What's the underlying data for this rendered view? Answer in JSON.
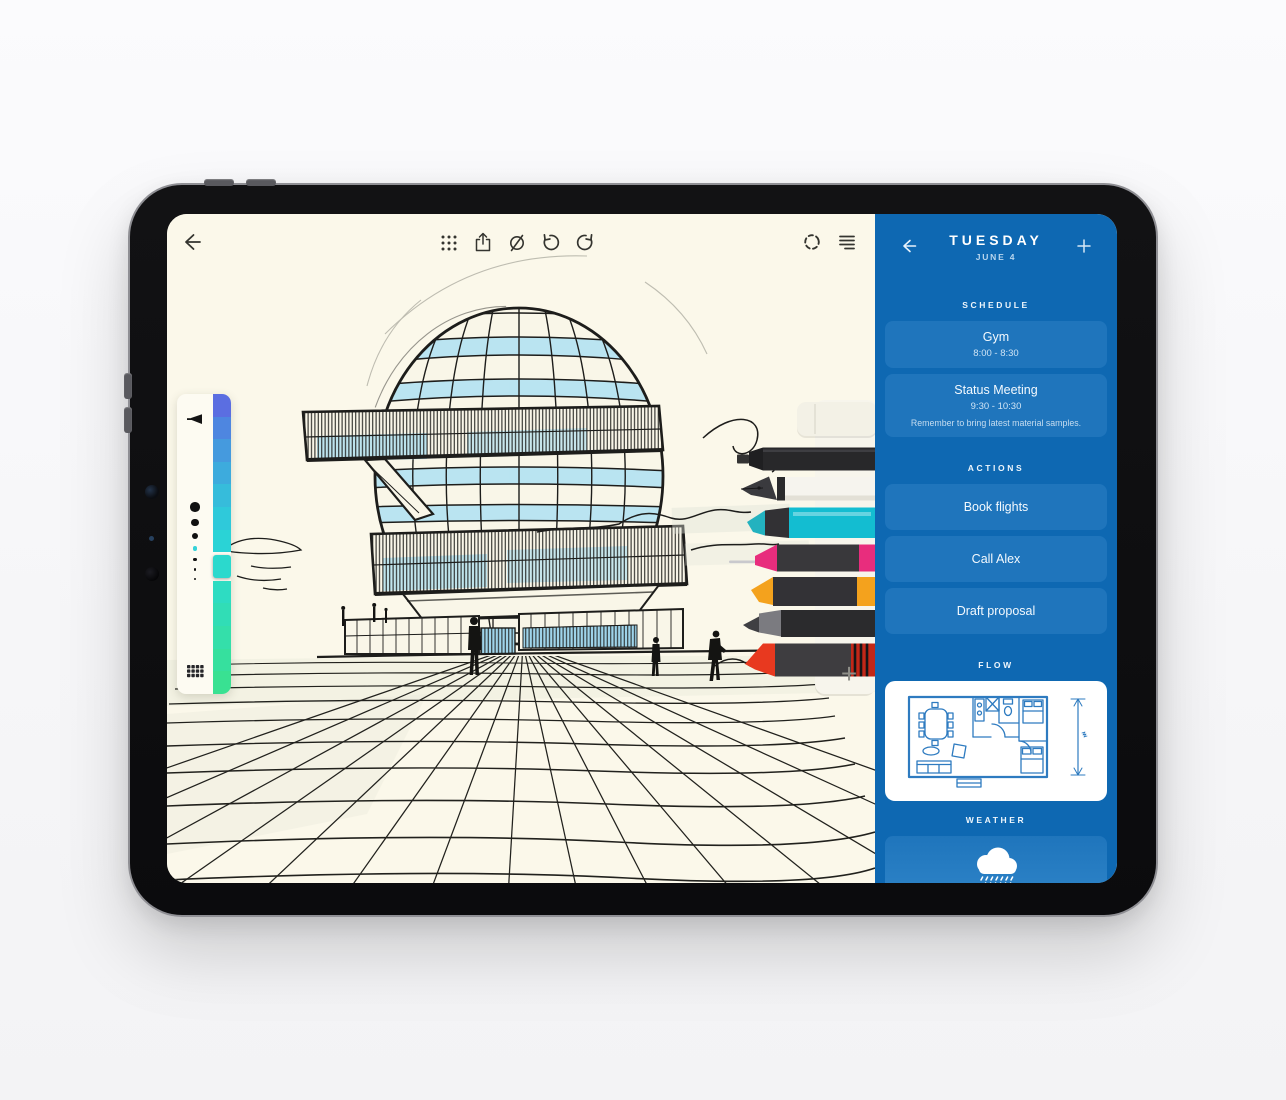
{
  "canvas_app": {
    "toolbar": {
      "icons_left": [
        "back-arrow"
      ],
      "icons_center": [
        "grid-dots",
        "share",
        "slashed-circle",
        "undo",
        "redo"
      ],
      "icons_right": [
        "selection-circle",
        "align-right-lines"
      ]
    },
    "palette": {
      "colors": [
        "#5b6ee1",
        "#4e86e0",
        "#459ade",
        "#3dabdd",
        "#36bcdb",
        "#2fc9da",
        "#2ad3d6",
        "#2bd9cd",
        "#2edcc2",
        "#31ddb6",
        "#34dfaa",
        "#36e09e",
        "#39e192"
      ],
      "selected_index": 7,
      "brush_sizes": [
        9.5,
        7.5,
        6,
        4.6,
        3.6,
        2.8,
        2
      ],
      "selected_size_index": 3,
      "selected_size_color": "#35d2d8"
    },
    "pens": [
      {
        "name": "eraser",
        "color": "#f3f1e6"
      },
      {
        "name": "black-fineliner",
        "color": "#28282a"
      },
      {
        "name": "fountain-pen",
        "color": "#f6f4ee"
      },
      {
        "name": "teal-highlighter",
        "color": "#13bdd1"
      },
      {
        "name": "pink-fineliner",
        "color": "#e82d7d"
      },
      {
        "name": "orange-marker",
        "color": "#f4a21d"
      },
      {
        "name": "gray-pencil",
        "color": "#7b7b80"
      },
      {
        "name": "red-marker",
        "color": "#e8391f"
      }
    ],
    "add_tool_label": "+",
    "ink_color": "#1d1d1b",
    "window_blue": "#a8def0",
    "paper_color": "#fbf8ea"
  },
  "sidebar": {
    "title": "TUESDAY",
    "date": "JUNE 4",
    "schedule": {
      "label": "SCHEDULE",
      "events": [
        {
          "title": "Gym",
          "time": "8:00 - 8:30"
        },
        {
          "title": "Status Meeting",
          "time": "9:30 - 10:30",
          "note": "Remember to bring latest material samples."
        }
      ]
    },
    "actions": {
      "label": "ACTIONS",
      "items": [
        {
          "title": "Book flights"
        },
        {
          "title": "Call Alex"
        },
        {
          "title": "Draft proposal"
        }
      ]
    },
    "flow": {
      "label": "FLOW"
    },
    "weather": {
      "label": "WEATHER"
    },
    "colors": {
      "background": "#0e68b2",
      "card": "#1f75bc",
      "plan_ink": "#2e7bc0"
    }
  }
}
